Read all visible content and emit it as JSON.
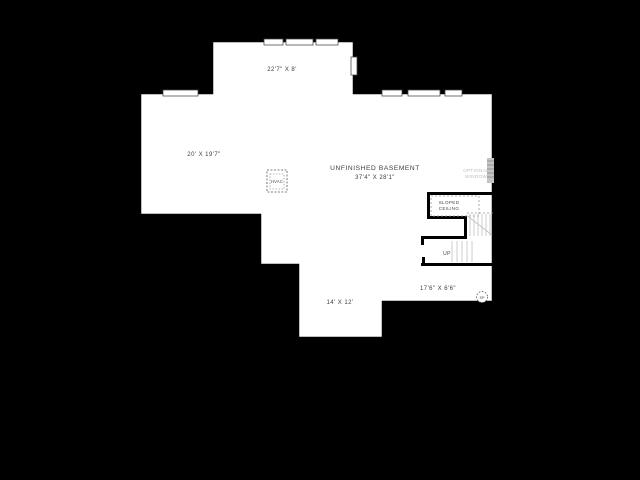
{
  "floorplan": {
    "rooms": [
      {
        "id": "top-room",
        "dimensions": "22'7\" X 8'"
      },
      {
        "id": "left-room",
        "dimensions": "20' X 19'7\""
      },
      {
        "id": "main-room",
        "label": "UNFINISHED BASEMENT",
        "dimensions": "37'4\" X 28'1\""
      },
      {
        "id": "bottom-room",
        "dimensions": "14' X 12'"
      },
      {
        "id": "bottom-right-room",
        "dimensions": "17'6\" X 6'6\""
      }
    ],
    "annotations": {
      "hvac": "HVAC",
      "optional_window": [
        "OPTIONAL",
        "WINDOW"
      ],
      "sloped_ceiling": [
        "SLOPED",
        "CEILING"
      ],
      "stairs_up": "UP",
      "sump_pump": "SP"
    },
    "colors": {
      "background": "#000000",
      "floor": "#ffffff",
      "walls": "#000000",
      "stair_detail": "#c0c0c0",
      "dashed_detail": "#8f8f8f",
      "label_text": "#3d3d3d",
      "muted_text": "#bdbdbd",
      "optional_window_fill": "#c4c4c4"
    }
  }
}
